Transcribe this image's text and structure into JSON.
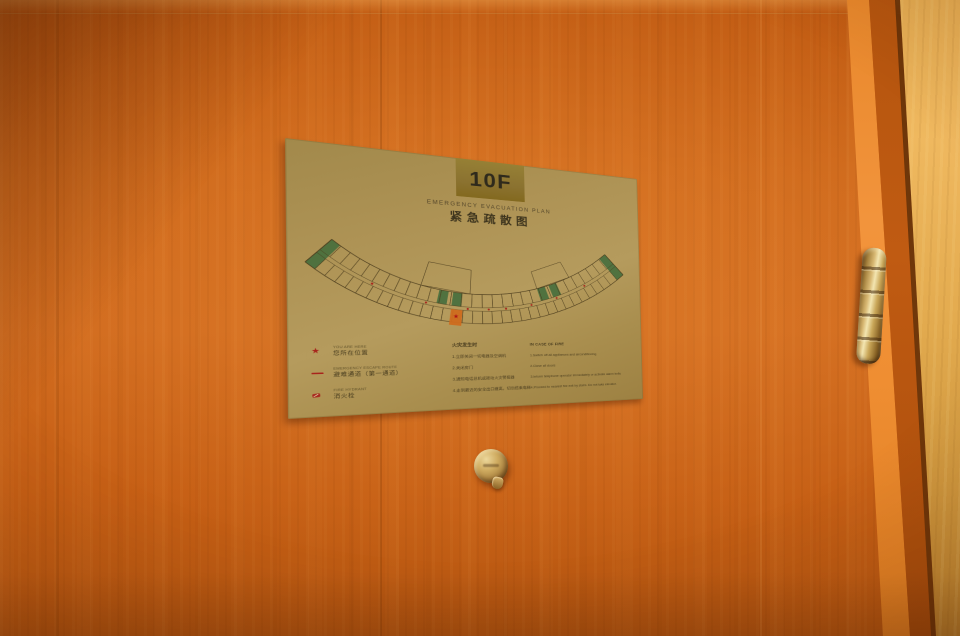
{
  "sign": {
    "floor": "10F",
    "title_en": "EMERGENCY EVACUATION PLAN",
    "title_zh": "紧急疏散图",
    "legend": [
      {
        "icon": "you-are-here-star",
        "en": "YOU ARE HERE",
        "zh": "您所在位置"
      },
      {
        "icon": "escape-route-line",
        "en": "EMERGENCY ESCAPE ROUTE",
        "zh": "避难通道（第一通道）"
      },
      {
        "icon": "fire-extinguisher",
        "en": "FIRE HYDRANT",
        "zh": "消火栓"
      }
    ],
    "instructions_zh": {
      "header": "火灾发生时",
      "items": [
        "1.立即关闭一切电器及空调机",
        "2.关闭房门",
        "3.通知电话总机或按动火灾警报器",
        "4.走到最近的安全出口撤离，切勿搭乘电梯"
      ]
    },
    "instructions_en": {
      "header": "IN CASE OF FIRE",
      "items": [
        "1.Switch off all appliances and airconditioning",
        "2.Close all doors",
        "3.Inform telephone operator immediately or activate alarm bells",
        "4.Proceed to nearest fire exit by stairs. Do not take elevator."
      ]
    },
    "colors": {
      "plate": "#ab9053",
      "badge": "#8b7230",
      "text": "#4a3d1f"
    },
    "plan": {
      "line_color": "#4a3b1c",
      "exit_color": "#3e6b3b",
      "hydrant_color": "#a8281e",
      "you_are_here_color": "#cf6b1d",
      "star_color": "#b01515",
      "star_glyph": "★",
      "exits": [
        [
          0.0,
          0.03,
          "full"
        ],
        [
          0.36,
          0.39,
          "inner"
        ],
        [
          0.405,
          0.435,
          "inner"
        ],
        [
          0.695,
          0.725,
          "inner"
        ],
        [
          0.74,
          0.77,
          "inner"
        ],
        [
          0.97,
          1.0,
          "full"
        ]
      ],
      "hydrants": [
        0.17,
        0.33,
        0.455,
        0.52,
        0.575,
        0.66,
        0.75,
        0.86
      ],
      "you_are_here_t": 0.4225,
      "lobbies": [
        [
          0.3,
          0.46,
          355
        ],
        [
          0.695,
          0.825,
          368
        ]
      ]
    }
  },
  "door": {
    "colors": {
      "face": "#cc661a",
      "edge_highlight": "#f2943c",
      "frame": "#e6ad53",
      "hinge_brass": "#d8b873",
      "peephole_brass": "#cfab60"
    }
  }
}
